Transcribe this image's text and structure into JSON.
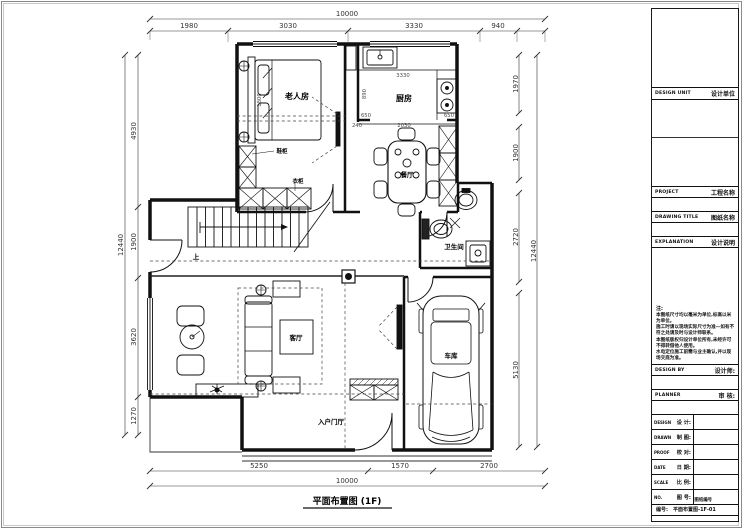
{
  "plan": {
    "title": "平面布置图 (1F)",
    "rooms": {
      "bedroom": "老人房",
      "kitchen": "厨房",
      "dining": "餐厅",
      "bath": "卫生间",
      "living": "客厅",
      "garage": "车库",
      "entry": "入户门厅"
    },
    "labels": {
      "up": "上",
      "shoe_cabinet": "鞋柜",
      "wardrobe": "衣柜"
    },
    "dims": {
      "top_overall": "10000",
      "bottom_overall": "10000",
      "left_overall": "12440",
      "right_overall": "12440",
      "top": [
        "1980",
        "3030",
        "3330",
        "940"
      ],
      "bottom": [
        "5250",
        "1570",
        "2700"
      ],
      "left": [
        "4930",
        "1900",
        "3620",
        "1270"
      ],
      "right": [
        "1970",
        "1900",
        "2720",
        "5130"
      ],
      "kitchen_width": "3330",
      "kitchen_depth": "890",
      "counter_left": "650",
      "counter_right": "650",
      "pass_opening": "2030",
      "jamb": "240",
      "bed_width": "1800"
    }
  },
  "titleblock": {
    "design_unit_en": "DESIGN UNIT",
    "design_unit_cn": "设计单位",
    "project_en": "PROJECT",
    "project_cn": "工程名称",
    "drawing_title_en": "DRAWING TITLE",
    "drawing_title_cn": "图纸名称",
    "explanation_en": "EXPLANATION",
    "explanation_cn": "设计说明",
    "notes_head": "注:",
    "notes": [
      "本图纸尺寸均以毫米为单位,标高以米为单位。",
      "施工时请以现场实际尺寸为准—如有不符之处请及时与设计师联系。",
      "本图纸版权归设计单位所有,未经许可不得转借他人使用。",
      "水电定位施工前需与业主确认,并以现场交底为准。"
    ],
    "design_by_en": "DESIGN BY",
    "design_by_cn": "设计师:",
    "planner_en": "PLANNER",
    "planner_cn": "审 核:",
    "rows": [
      {
        "en": "DESIGN",
        "cn": "设 计:"
      },
      {
        "en": "DRAWN",
        "cn": "制 图:"
      },
      {
        "en": "PROOF",
        "cn": "校 对:"
      },
      {
        "en": "DATE",
        "cn": "日 期:"
      },
      {
        "en": "SCALE",
        "cn": "比 例:"
      },
      {
        "en": "NO.",
        "cn": "图 号:"
      }
    ],
    "drawing_no_caption": "图纸编号",
    "drawing_no_label": "编号:",
    "drawing_no_value": "平面布置图-1F-01"
  }
}
